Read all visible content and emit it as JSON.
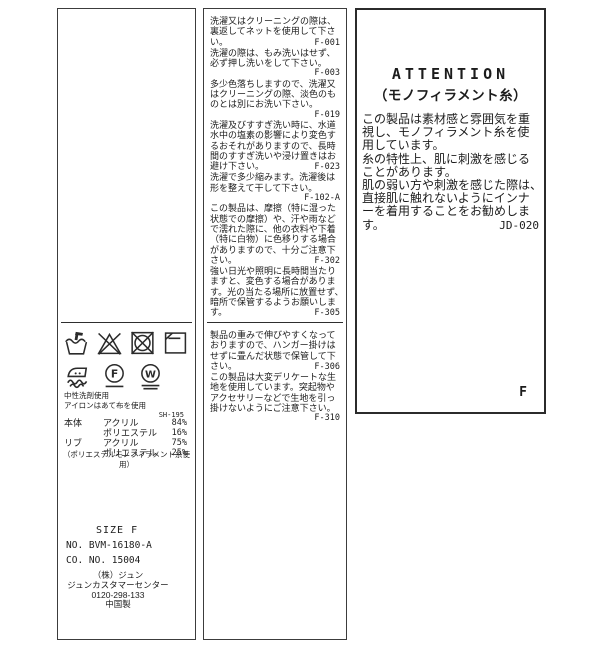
{
  "left_panel": {
    "care_symbols": [
      "hand-wash",
      "do-not-bleach",
      "do-not-tumble-dry",
      "dry-flat-in-shade",
      "iron-with-pressing-cloth",
      "dry-clean-F-gentle",
      "wet-clean-W-very-gentle"
    ],
    "usage_notes": [
      "中性洗剤使用",
      "アイロンはあて布を使用"
    ],
    "code": "SH-195",
    "composition": {
      "rows": [
        {
          "part": "本体",
          "fiber": "アクリル",
          "pct": "84%"
        },
        {
          "part": "",
          "fiber": "ポリエステル",
          "pct": "16%"
        },
        {
          "part": "リブ",
          "fiber": "アクリル",
          "pct": "75%"
        },
        {
          "part": "",
          "fiber": "ポリエステル",
          "pct": "25%"
        }
      ],
      "note": "（ポリエステルモノフィラメント糸使用）"
    },
    "size_label": "SIZE F",
    "product_no": "NO. BVM-16180-A",
    "co_no": "CO. NO.  15004",
    "maker": [
      "（株）ジュン",
      "ジュンカスタマーセンター",
      "0120-298-133",
      "中国製"
    ]
  },
  "middle_panel": {
    "block1": [
      {
        "t": "洗濯又はクリーニングの際は、",
        "c": ""
      },
      {
        "t": "裏返してネットを使用して下さ",
        "c": ""
      },
      {
        "t": "い。",
        "c": "F-001"
      },
      {
        "t": "洗濯の際は、もみ洗いはせず、",
        "c": ""
      },
      {
        "t": "必ず押し洗いをして下さい。",
        "c": ""
      },
      {
        "t": "",
        "c": "F-003"
      },
      {
        "t": "多少色落ちしますので、洗濯又",
        "c": ""
      },
      {
        "t": "はクリーニングの際、淡色のも",
        "c": ""
      },
      {
        "t": "のとは別にお洗い下さい。",
        "c": ""
      },
      {
        "t": "",
        "c": "F-019"
      },
      {
        "t": "洗濯及びすすぎ洗い時に、水道",
        "c": ""
      },
      {
        "t": "水中の塩素の影響により変色す",
        "c": ""
      },
      {
        "t": "るおそれがありますので、長時",
        "c": ""
      },
      {
        "t": "間のすすぎ洗いや浸け置きはお",
        "c": ""
      },
      {
        "t": "避け下さい。",
        "c": "F-023"
      },
      {
        "t": "洗濯で多少縮みます。洗濯後は",
        "c": ""
      },
      {
        "t": "形を整えて干して下さい。",
        "c": ""
      },
      {
        "t": "",
        "c": "F-102-A"
      },
      {
        "t": "この製品は、摩擦（特に湿った",
        "c": ""
      },
      {
        "t": "状態での摩擦）や、汗や雨など",
        "c": ""
      },
      {
        "t": "で濡れた際に、他の衣料や下着",
        "c": ""
      },
      {
        "t": "（特に白物）に色移りする場合",
        "c": ""
      },
      {
        "t": "がありますので、十分ご注意下",
        "c": ""
      },
      {
        "t": "さい。",
        "c": "F-302"
      },
      {
        "t": "強い日光や照明に長時間当たり",
        "c": ""
      },
      {
        "t": "ますと、変色する場合がありま",
        "c": ""
      },
      {
        "t": "す。光の当たる場所に放置せず、",
        "c": ""
      },
      {
        "t": "暗所で保管するようお願いしま",
        "c": ""
      },
      {
        "t": "す。",
        "c": "F-305"
      }
    ],
    "block2": [
      {
        "t": "製品の重みで伸びやすくなって",
        "c": ""
      },
      {
        "t": "おりますので、ハンガー掛けは",
        "c": ""
      },
      {
        "t": "せずに畳んだ状態で保管して下",
        "c": ""
      },
      {
        "t": "さい。",
        "c": "F-306"
      },
      {
        "t": "この製品は大変デリケートな生",
        "c": ""
      },
      {
        "t": "地を使用しています。突起物や",
        "c": ""
      },
      {
        "t": "アクセサリーなどで生地を引っ",
        "c": ""
      },
      {
        "t": "掛けないようにご注意下さい。",
        "c": ""
      },
      {
        "t": "",
        "c": "F-310"
      }
    ]
  },
  "right_panel": {
    "title": "ATTENTION",
    "subtitle": "（モノフィラメント糸）",
    "body": [
      {
        "t": "この製品は素材感と雰囲気を重",
        "c": ""
      },
      {
        "t": "視し、モノフィラメント糸を使",
        "c": ""
      },
      {
        "t": "用しています。",
        "c": ""
      },
      {
        "t": "糸の特性上、肌に刺激を感じる",
        "c": ""
      },
      {
        "t": "ことがあります。",
        "c": ""
      },
      {
        "t": "肌の弱い方や刺激を感じた際は、",
        "c": ""
      },
      {
        "t": "直接肌に触れないようにインナ",
        "c": ""
      },
      {
        "t": "ーを着用することをお勧めしま",
        "c": ""
      },
      {
        "t": "す。",
        "c": "JD-020"
      }
    ],
    "size_mark": "F"
  }
}
